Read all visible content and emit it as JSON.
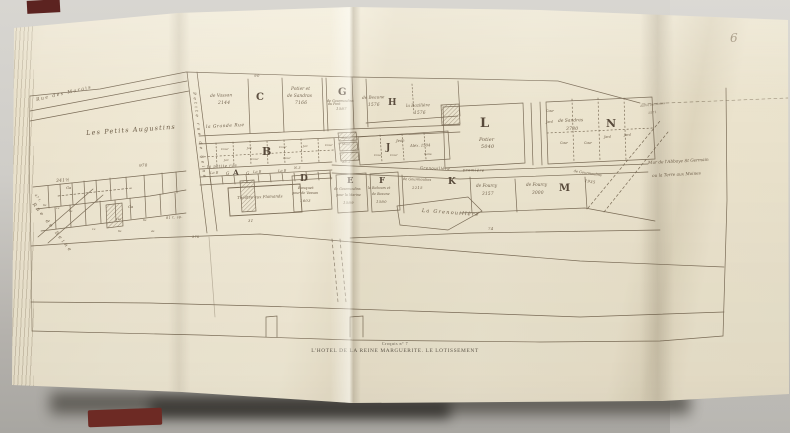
{
  "colors": {
    "paper": "#ece4cf",
    "ink": "#6b5c47",
    "background": "#cfcdc8",
    "book_cover_red": "#6d2a24"
  },
  "photo": {
    "page_number": "6"
  },
  "caption": {
    "kicker": "Croquis n° 7",
    "title": "L'HOTEL DE LA REINE MARGUERITE. LE LOTISSEMENT"
  },
  "map": {
    "labels": [
      {
        "t": "Rue des Marais",
        "x": 36,
        "y": 99,
        "s": 4.6,
        "r": -13,
        "c": "dstreet",
        "n": "label-rue-des-marais"
      },
      {
        "t": "Petite rue de Seine",
        "x": 196,
        "y": 92,
        "s": 4.2,
        "r": 83,
        "c": "vstreet",
        "n": "label-petite-rue-de-seine"
      },
      {
        "t": "Rue de Seine",
        "x": 34,
        "y": 203,
        "s": 4.8,
        "r": 52,
        "c": "vstreet",
        "n": "label-rue-de-seine"
      },
      {
        "t": "Les Petits Augustins",
        "x": 86,
        "y": 130,
        "s": 6.4,
        "r": -4,
        "c": "area",
        "n": "label-les-petits-augustins"
      },
      {
        "t": "la Grande Rue",
        "x": 206,
        "y": 126,
        "s": 4.4,
        "r": -3,
        "c": "street",
        "n": "label-la-grande-rue"
      },
      {
        "t": "la petite rue",
        "x": 207,
        "y": 165,
        "s": 3.8,
        "r": -3,
        "c": "street",
        "n": "label-la-petite-rue"
      },
      {
        "t": "Grenouillère",
        "x": 420,
        "y": 166,
        "s": 3.8,
        "r": 2,
        "c": "street"
      },
      {
        "t": "première",
        "x": 463,
        "y": 168,
        "s": 3.8,
        "r": 2,
        "c": "street"
      },
      {
        "t": "La Grenouillère",
        "x": 422,
        "y": 209,
        "s": 5,
        "r": 4,
        "c": "area",
        "n": "label-la-grenouillere"
      },
      {
        "t": "90",
        "x": 254,
        "y": 74,
        "s": 4,
        "r": 0,
        "c": "num"
      },
      {
        "t": "de Vassan",
        "x": 210,
        "y": 95,
        "s": 4.4,
        "r": -2,
        "c": "hand"
      },
      {
        "t": "2144",
        "x": 218,
        "y": 102,
        "s": 4.4,
        "r": 0,
        "c": "num"
      },
      {
        "t": "C",
        "x": 256,
        "y": 93,
        "s": 10,
        "r": 0,
        "c": "letter",
        "n": "letter-C"
      },
      {
        "t": "Potier et",
        "x": 291,
        "y": 88,
        "s": 4.4,
        "r": 0,
        "c": "hand"
      },
      {
        "t": "de Sandras",
        "x": 287,
        "y": 95,
        "s": 4.4,
        "r": 0,
        "c": "hand"
      },
      {
        "t": "7166",
        "x": 295,
        "y": 102,
        "s": 4.4,
        "r": 0,
        "c": "num"
      },
      {
        "t": "du Pont",
        "x": 328,
        "y": 103,
        "s": 3.2,
        "r": 0,
        "c": "hand"
      },
      {
        "t": "G",
        "x": 338,
        "y": 88,
        "s": 10,
        "r": 0,
        "c": "letter",
        "n": "letter-G"
      },
      {
        "t": "de Gourmoulins",
        "x": 327,
        "y": 100,
        "s": 3.3,
        "r": 0,
        "c": "hand"
      },
      {
        "t": "1587",
        "x": 336,
        "y": 107,
        "s": 3.8,
        "r": 0,
        "c": "num"
      },
      {
        "t": "de Beaune",
        "x": 362,
        "y": 96,
        "s": 4.2,
        "r": -2,
        "c": "hand"
      },
      {
        "t": "1576",
        "x": 368,
        "y": 103,
        "s": 4.2,
        "r": 0,
        "c": "num"
      },
      {
        "t": "H",
        "x": 388,
        "y": 99,
        "s": 9,
        "r": 0,
        "c": "letter",
        "n": "letter-H"
      },
      {
        "t": "la Bazilière",
        "x": 406,
        "y": 104,
        "s": 4.2,
        "r": -2,
        "c": "hand"
      },
      {
        "t": "1576",
        "x": 414,
        "y": 111,
        "s": 4.2,
        "r": 0,
        "c": "num"
      },
      {
        "t": "L",
        "x": 480,
        "y": 117,
        "s": 13,
        "r": 0,
        "c": "letter",
        "n": "letter-L"
      },
      {
        "t": "Potier",
        "x": 479,
        "y": 138,
        "s": 5,
        "r": 0,
        "c": "hand"
      },
      {
        "t": "5040",
        "x": 481,
        "y": 146,
        "s": 4.8,
        "r": 0,
        "c": "num"
      },
      {
        "t": "de Sandras",
        "x": 558,
        "y": 120,
        "s": 4.4,
        "r": -2,
        "c": "hand"
      },
      {
        "t": "3780",
        "x": 566,
        "y": 128,
        "s": 4.4,
        "r": 0,
        "c": "num"
      },
      {
        "t": "N",
        "x": 606,
        "y": 118,
        "s": 11,
        "r": 0,
        "c": "letter",
        "n": "letter-N"
      },
      {
        "t": "Cour",
        "x": 546,
        "y": 110,
        "s": 3.2,
        "r": 0,
        "c": "hand"
      },
      {
        "t": "Jard",
        "x": 546,
        "y": 121,
        "s": 3.2,
        "r": 0,
        "c": "hand"
      },
      {
        "t": "Cour",
        "x": 560,
        "y": 142,
        "s": 3.2,
        "r": 0,
        "c": "hand"
      },
      {
        "t": "Cour",
        "x": 584,
        "y": 142,
        "s": 3.2,
        "r": 0,
        "c": "hand"
      },
      {
        "t": "Jard",
        "x": 604,
        "y": 136,
        "s": 3.2,
        "r": 0,
        "c": "hand"
      },
      {
        "t": "Jard",
        "x": 624,
        "y": 134,
        "s": 3.2,
        "r": 0,
        "c": "hand"
      },
      {
        "t": "B",
        "x": 262,
        "y": 146,
        "s": 11,
        "r": 0,
        "c": "letter",
        "n": "letter-B"
      },
      {
        "t": "Cour",
        "x": 221,
        "y": 148,
        "s": 3.1,
        "r": 0,
        "c": "hand"
      },
      {
        "t": "Jar.",
        "x": 247,
        "y": 147,
        "s": 3.1,
        "r": 0,
        "c": "hand"
      },
      {
        "t": "Cour",
        "x": 279,
        "y": 146,
        "s": 3.1,
        "r": 0,
        "c": "hand"
      },
      {
        "t": "Jar.",
        "x": 303,
        "y": 145,
        "s": 3.1,
        "r": 0,
        "c": "hand"
      },
      {
        "t": "Cour",
        "x": 325,
        "y": 144,
        "s": 3.1,
        "r": 0,
        "c": "hand"
      },
      {
        "t": "Jar.",
        "x": 224,
        "y": 159,
        "s": 3.1,
        "r": 0,
        "c": "hand"
      },
      {
        "t": "Cour",
        "x": 251,
        "y": 158,
        "s": 3.1,
        "r": 0,
        "c": "hand"
      },
      {
        "t": "Cour",
        "x": 283,
        "y": 157,
        "s": 3.1,
        "r": 0,
        "c": "hand"
      },
      {
        "t": "Hôtel",
        "x": 342,
        "y": 137,
        "s": 2.9,
        "r": 0,
        "c": "hand"
      },
      {
        "t": "Marg.",
        "x": 342,
        "y": 143,
        "s": 2.9,
        "r": 0,
        "c": "hand"
      },
      {
        "t": "J",
        "x": 386,
        "y": 144,
        "s": 9,
        "r": 0,
        "c": "letter",
        "n": "letter-J"
      },
      {
        "t": "Jean",
        "x": 396,
        "y": 139,
        "s": 3.8,
        "r": -2,
        "c": "hand"
      },
      {
        "t": "Alex. 1504",
        "x": 410,
        "y": 144,
        "s": 3.8,
        "r": -2,
        "c": "hand"
      },
      {
        "t": "Cour",
        "x": 374,
        "y": 154,
        "s": 3.1,
        "r": 0,
        "c": "hand"
      },
      {
        "t": "Cour",
        "x": 390,
        "y": 154,
        "s": 3.1,
        "r": 0,
        "c": "hand"
      },
      {
        "t": "Sans",
        "x": 424,
        "y": 153,
        "s": 3.1,
        "r": 0,
        "c": "hand"
      },
      {
        "t": "35.2",
        "x": 342,
        "y": 161,
        "s": 3.4,
        "r": 0,
        "c": "num"
      },
      {
        "t": "N.3",
        "x": 294,
        "y": 167,
        "s": 3.4,
        "r": 0,
        "c": "num"
      },
      {
        "t": "La B",
        "x": 210,
        "y": 172,
        "s": 3.6,
        "r": -2,
        "c": "hand"
      },
      {
        "t": "G",
        "x": 226,
        "y": 172,
        "s": 4.2,
        "r": 0,
        "c": "hand"
      },
      {
        "t": "A",
        "x": 233,
        "y": 169,
        "s": 7.5,
        "r": 0,
        "c": "letter",
        "n": "letter-A"
      },
      {
        "t": "G",
        "x": 246,
        "y": 172,
        "s": 4.2,
        "r": 0,
        "c": "hand"
      },
      {
        "t": "La B",
        "x": 253,
        "y": 171,
        "s": 3.6,
        "r": -2,
        "c": "hand"
      },
      {
        "t": "La B",
        "x": 278,
        "y": 170,
        "s": 3.6,
        "r": -2,
        "c": "hand"
      },
      {
        "t": "Théâtre aux Flamands",
        "x": 237,
        "y": 196,
        "s": 4,
        "r": -2,
        "c": "hand",
        "n": "label-theatre-aux-flamands"
      },
      {
        "t": "31",
        "x": 248,
        "y": 219,
        "s": 3.8,
        "r": 0,
        "c": "num"
      },
      {
        "t": "D",
        "x": 300,
        "y": 175,
        "s": 9,
        "r": 0,
        "c": "letter",
        "n": "letter-D"
      },
      {
        "t": "Bosquet",
        "x": 298,
        "y": 186,
        "s": 3.8,
        "r": 0,
        "c": "hand"
      },
      {
        "t": "pour de Vassan",
        "x": 292,
        "y": 192,
        "s": 3.4,
        "r": 0,
        "c": "hand"
      },
      {
        "t": "1603",
        "x": 300,
        "y": 199,
        "s": 3.8,
        "r": 0,
        "c": "num"
      },
      {
        "t": "E",
        "x": 347,
        "y": 177,
        "s": 8.5,
        "r": 0,
        "c": "letter",
        "n": "letter-E"
      },
      {
        "t": "de Gourmoulins",
        "x": 334,
        "y": 188,
        "s": 3.3,
        "r": 0,
        "c": "hand"
      },
      {
        "t": "pour la Marine",
        "x": 336,
        "y": 194,
        "s": 3.3,
        "r": 0,
        "c": "hand"
      },
      {
        "t": "1589",
        "x": 343,
        "y": 201,
        "s": 3.8,
        "r": 0,
        "c": "num"
      },
      {
        "t": "F",
        "x": 379,
        "y": 177,
        "s": 8.5,
        "r": 0,
        "c": "letter",
        "n": "letter-F"
      },
      {
        "t": "le Rebours et",
        "x": 368,
        "y": 187,
        "s": 3.3,
        "r": 0,
        "c": "hand"
      },
      {
        "t": "de Beaune",
        "x": 372,
        "y": 193,
        "s": 3.3,
        "r": 0,
        "c": "hand"
      },
      {
        "t": "1580",
        "x": 376,
        "y": 200,
        "s": 3.8,
        "r": 0,
        "c": "num"
      },
      {
        "t": "de Gourmoulins",
        "x": 403,
        "y": 178,
        "s": 3.5,
        "r": 2,
        "c": "hand"
      },
      {
        "t": "2215",
        "x": 412,
        "y": 186,
        "s": 3.8,
        "r": 0,
        "c": "num"
      },
      {
        "t": "K",
        "x": 448,
        "y": 178,
        "s": 9,
        "r": 0,
        "c": "letter",
        "n": "letter-K"
      },
      {
        "t": "de Fourcy",
        "x": 476,
        "y": 184,
        "s": 4.2,
        "r": 0,
        "c": "hand"
      },
      {
        "t": "3157",
        "x": 482,
        "y": 192,
        "s": 4.2,
        "r": 0,
        "c": "num"
      },
      {
        "t": "de Fourcy",
        "x": 526,
        "y": 183,
        "s": 4.2,
        "r": 0,
        "c": "hand"
      },
      {
        "t": "3000",
        "x": 532,
        "y": 191,
        "s": 4.2,
        "r": 0,
        "c": "num"
      },
      {
        "t": "M",
        "x": 559,
        "y": 184,
        "s": 10,
        "r": 0,
        "c": "letter",
        "n": "letter-M"
      },
      {
        "t": "de Gourmoulins",
        "x": 574,
        "y": 170,
        "s": 3.5,
        "r": 9,
        "c": "hand"
      },
      {
        "t": "1935",
        "x": 585,
        "y": 179,
        "s": 3.8,
        "r": 9,
        "c": "num"
      },
      {
        "t": "74",
        "x": 488,
        "y": 227,
        "s": 3.8,
        "r": 0,
        "c": "num"
      },
      {
        "t": "du Pré des Moines",
        "x": 640,
        "y": 105,
        "s": 2.7,
        "r": -7,
        "c": "hand"
      },
      {
        "t": "1571",
        "x": 648,
        "y": 112,
        "s": 3,
        "r": -7,
        "c": "num"
      },
      {
        "t": "Mur de l'Abbaye St Germain",
        "x": 648,
        "y": 161,
        "s": 4.2,
        "r": -3,
        "c": "hand",
        "n": "label-mur-abbaye"
      },
      {
        "t": "ou la Terre aux Moines",
        "x": 652,
        "y": 174,
        "s": 4.2,
        "r": -3,
        "c": "hand"
      },
      {
        "t": "341½",
        "x": 56,
        "y": 180,
        "s": 4.4,
        "r": -4,
        "c": "num"
      },
      {
        "t": "970",
        "x": 139,
        "y": 164,
        "s": 4,
        "r": -4,
        "c": "num"
      },
      {
        "t": "47 t.",
        "x": 36,
        "y": 194,
        "s": 3.2,
        "r": 50,
        "c": "num"
      },
      {
        "t": "81 t. sp.",
        "x": 166,
        "y": 217,
        "s": 3.4,
        "r": -4,
        "c": "num"
      },
      {
        "t": "378",
        "x": 192,
        "y": 236,
        "s": 3.4,
        "r": 0,
        "c": "num"
      },
      {
        "t": "Ga",
        "x": 66,
        "y": 186,
        "s": 3.8,
        "r": 0,
        "c": "hand"
      },
      {
        "t": "Ga",
        "x": 128,
        "y": 205,
        "s": 3.8,
        "r": 0,
        "c": "hand"
      },
      {
        "t": "6a",
        "x": 43,
        "y": 204,
        "s": 2.8,
        "r": 0,
        "c": "hand"
      },
      {
        "t": "1a",
        "x": 56,
        "y": 207,
        "s": 2.8,
        "r": 0,
        "c": "hand"
      },
      {
        "t": "6a",
        "x": 69,
        "y": 210,
        "s": 2.8,
        "r": 0,
        "c": "hand"
      },
      {
        "t": "14a",
        "x": 116,
        "y": 218,
        "s": 2.8,
        "r": 0,
        "c": "hand"
      },
      {
        "t": "6a",
        "x": 143,
        "y": 219,
        "s": 2.8,
        "r": 0,
        "c": "hand"
      },
      {
        "t": "1a",
        "x": 92,
        "y": 228,
        "s": 2.8,
        "r": 0,
        "c": "hand"
      },
      {
        "t": "6a",
        "x": 118,
        "y": 230,
        "s": 2.8,
        "r": 0,
        "c": "hand"
      },
      {
        "t": "4a",
        "x": 151,
        "y": 230,
        "s": 2.8,
        "r": 0,
        "c": "hand"
      }
    ]
  }
}
